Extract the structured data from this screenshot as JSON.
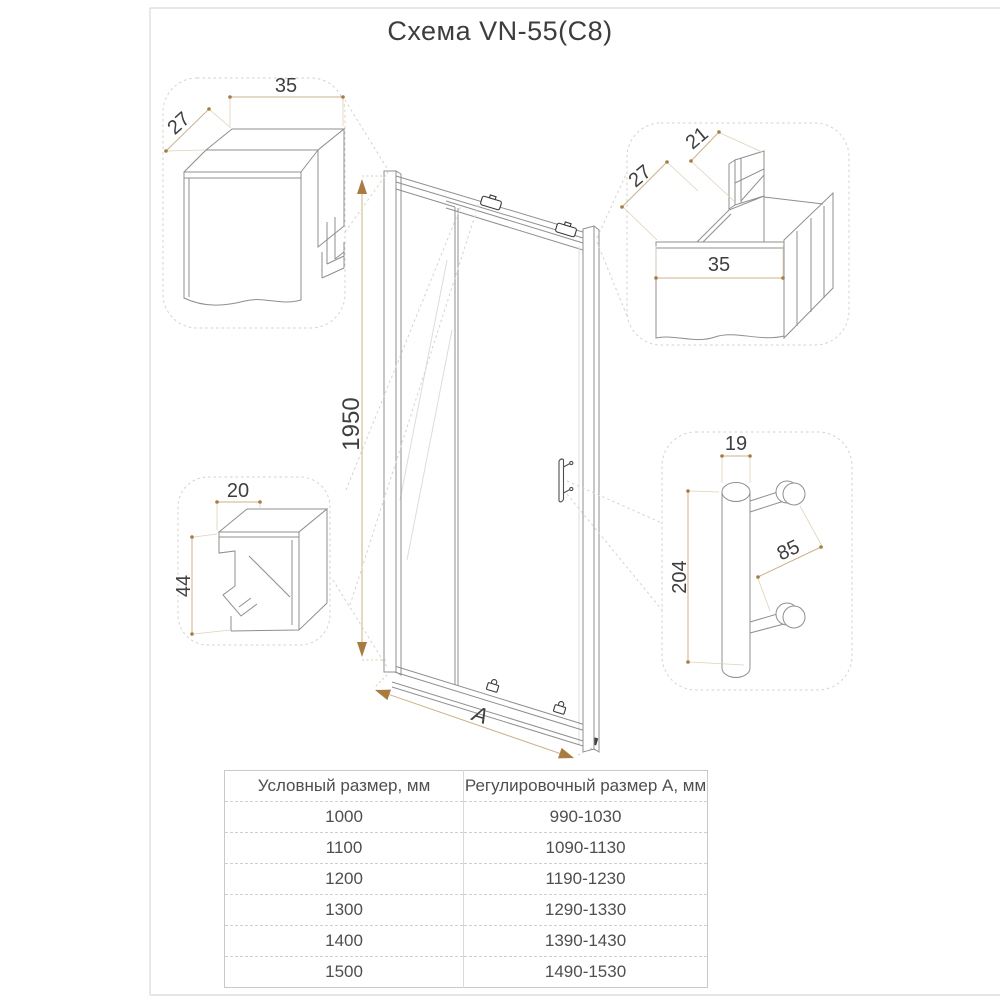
{
  "page": {
    "title": "Схема VN-55(C8)"
  },
  "drawing": {
    "door_height_mm": "1950",
    "door_width_label": "A"
  },
  "details": {
    "wall_profile": {
      "width_mm": "35",
      "depth_mm": "27"
    },
    "top_rail": {
      "track_mm": "21",
      "depth_mm": "27",
      "width_mm": "35"
    },
    "bottom_rail": {
      "width_mm": "20",
      "height_mm": "44"
    },
    "handle": {
      "diameter_mm": "19",
      "length_mm": "204",
      "hole_spacing_mm": "85"
    }
  },
  "table": {
    "columns": [
      "Условный размер, мм",
      "Регулировочный размер А, мм"
    ],
    "rows": [
      [
        "1000",
        "990-1030"
      ],
      [
        "1100",
        "1090-1130"
      ],
      [
        "1200",
        "1190-1230"
      ],
      [
        "1300",
        "1290-1330"
      ],
      [
        "1400",
        "1390-1430"
      ],
      [
        "1500",
        "1490-1530"
      ]
    ]
  },
  "colors": {
    "dimension_accent": "#a87c41",
    "line_art": "#8f8f8f",
    "callout": "#d7d2ca",
    "text": "#3f3f3f",
    "table_border": "#c9c9c9"
  }
}
